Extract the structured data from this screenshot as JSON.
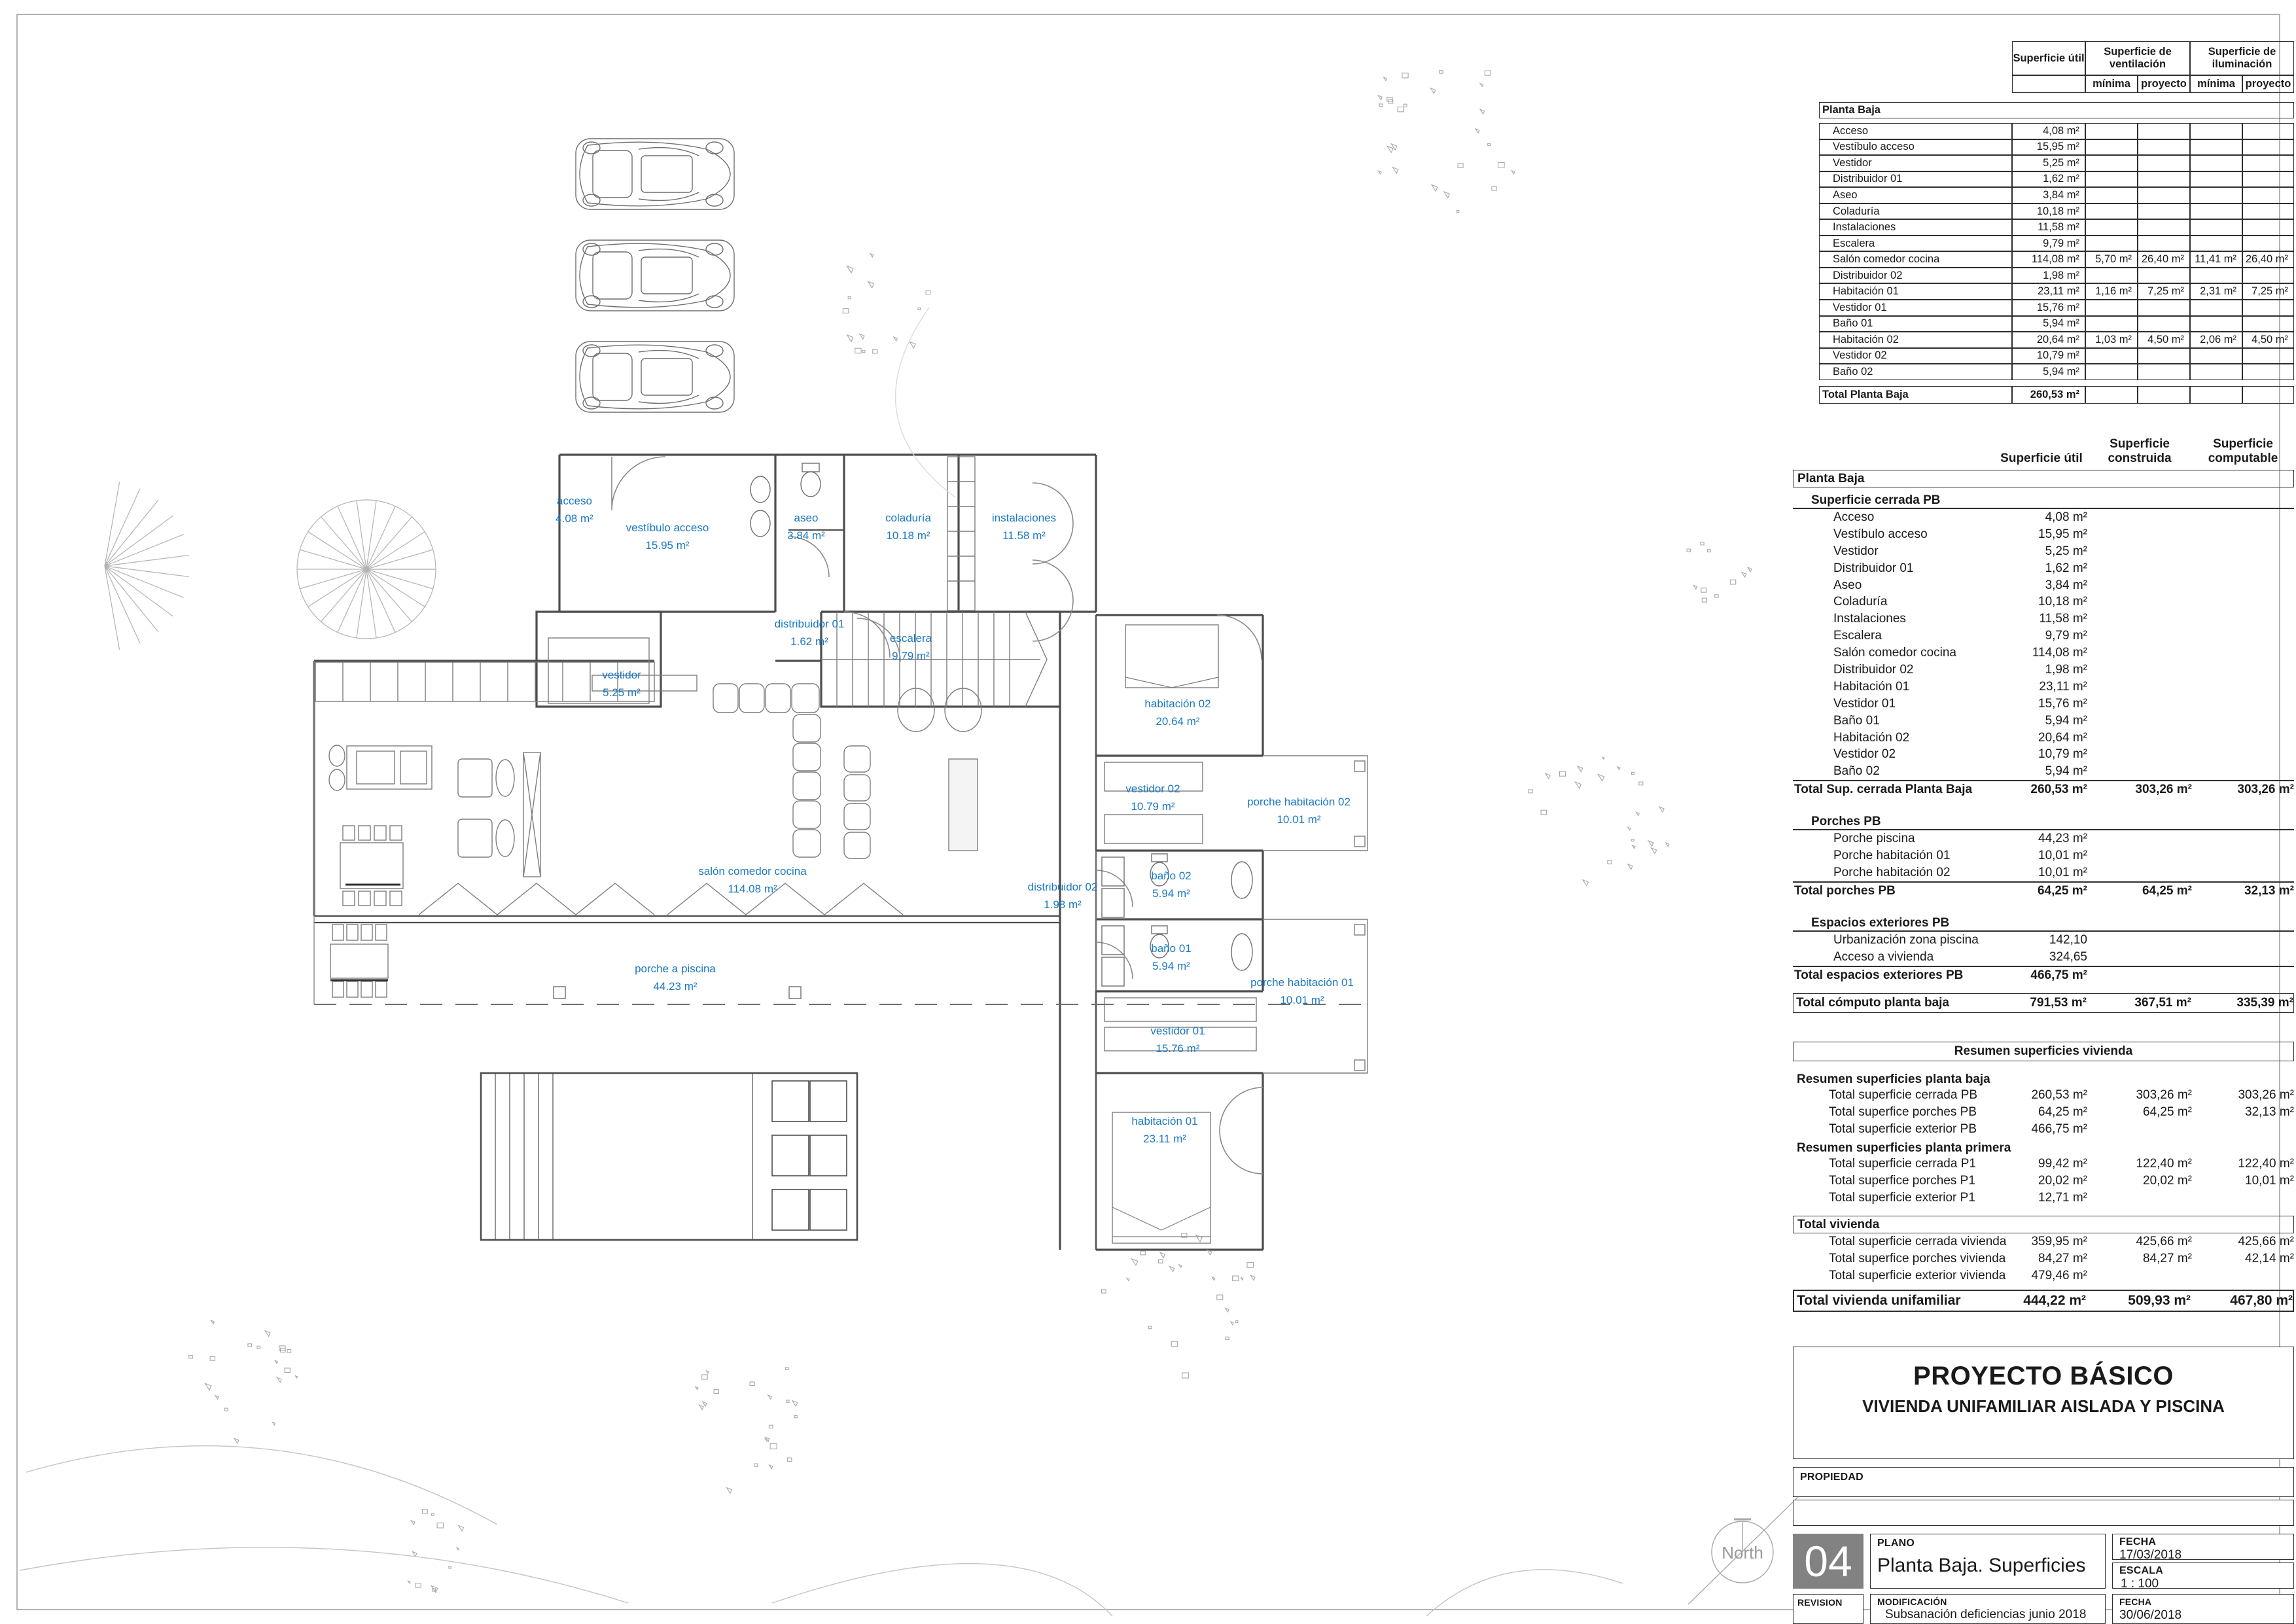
{
  "colors": {
    "accent_blue": "#1b79c2",
    "wall_line": "#4d4d4d",
    "table_line": "#2e2e2e",
    "sheet_number_bg": "#828282"
  },
  "plan": {
    "north_label": "North",
    "rooms": [
      {
        "name": "acceso",
        "area": "4.08 m²"
      },
      {
        "name": "vestíbulo acceso",
        "area": "15.95 m²"
      },
      {
        "name": "aseo",
        "area": "3.84 m²"
      },
      {
        "name": "coladuría",
        "area": "10.18 m²"
      },
      {
        "name": "instalaciones",
        "area": "11.58 m²"
      },
      {
        "name": "distribuidor 01",
        "area": "1.62 m²"
      },
      {
        "name": "vestidor",
        "area": "5.25 m²"
      },
      {
        "name": "escalera",
        "area": "9.79 m²"
      },
      {
        "name": "habitación 02",
        "area": "20.64 m²"
      },
      {
        "name": "vestidor 02",
        "area": "10.79 m²"
      },
      {
        "name": "porche habitación 02",
        "area": "10.01 m²"
      },
      {
        "name": "salón comedor cocina",
        "area": "114.08 m²"
      },
      {
        "name": "distribuidor 02",
        "area": "1.98 m²"
      },
      {
        "name": "baño 02",
        "area": "5.94 m²"
      },
      {
        "name": "baño 01",
        "area": "5.94 m²"
      },
      {
        "name": "porche a piscina",
        "area": "44.23 m²"
      },
      {
        "name": "porche habitación 01",
        "area": "10.01 m²"
      },
      {
        "name": "vestidor 01",
        "area": "15.76 m²"
      },
      {
        "name": "habitación 01",
        "area": "23.11 m²"
      }
    ]
  },
  "vent_table": {
    "header_util": "Superficie útil",
    "header_vent": "Superficie de ventilación",
    "header_ilum": "Superficie de iluminación",
    "sub_headers": [
      "mínima",
      "proyecto",
      "mínima",
      "proyecto"
    ],
    "section": "Planta Baja",
    "rows": [
      {
        "label": "Acceso",
        "util": "4,08 m²",
        "v": [
          "",
          "",
          "",
          ""
        ]
      },
      {
        "label": "Vestíbulo acceso",
        "util": "15,95 m²",
        "v": [
          "",
          "",
          "",
          ""
        ]
      },
      {
        "label": "Vestidor",
        "util": "5,25 m²",
        "v": [
          "",
          "",
          "",
          ""
        ]
      },
      {
        "label": "Distribuidor 01",
        "util": "1,62 m²",
        "v": [
          "",
          "",
          "",
          ""
        ]
      },
      {
        "label": "Aseo",
        "util": "3,84 m²",
        "v": [
          "",
          "",
          "",
          ""
        ]
      },
      {
        "label": "Coladuría",
        "util": "10,18 m²",
        "v": [
          "",
          "",
          "",
          ""
        ]
      },
      {
        "label": "Instalaciones",
        "util": "11,58 m²",
        "v": [
          "",
          "",
          "",
          ""
        ]
      },
      {
        "label": "Escalera",
        "util": "9,79 m²",
        "v": [
          "",
          "",
          "",
          ""
        ]
      },
      {
        "label": "Salón comedor cocina",
        "util": "114,08 m²",
        "v": [
          "5,70 m²",
          "26,40 m²",
          "11,41 m²",
          "26,40 m²"
        ]
      },
      {
        "label": "Distribuidor 02",
        "util": "1,98 m²",
        "v": [
          "",
          "",
          "",
          ""
        ]
      },
      {
        "label": "Habitación 01",
        "util": "23,11 m²",
        "v": [
          "1,16 m²",
          "7,25 m²",
          "2,31 m²",
          "7,25 m²"
        ]
      },
      {
        "label": "Vestidor 01",
        "util": "15,76 m²",
        "v": [
          "",
          "",
          "",
          ""
        ]
      },
      {
        "label": "Baño 01",
        "util": "5,94 m²",
        "v": [
          "",
          "",
          "",
          ""
        ]
      },
      {
        "label": "Habitación 02",
        "util": "20,64 m²",
        "v": [
          "1,03 m²",
          "4,50 m²",
          "2,06 m²",
          "4,50 m²"
        ]
      },
      {
        "label": "Vestidor 02",
        "util": "10,79 m²",
        "v": [
          "",
          "",
          "",
          ""
        ]
      },
      {
        "label": "Baño 02",
        "util": "5,94 m²",
        "v": [
          "",
          "",
          "",
          ""
        ]
      }
    ],
    "total": {
      "label": "Total Planta Baja",
      "util": "260,53 m²"
    }
  },
  "sup_table": {
    "header_cols": [
      "Superficie útil",
      "Superficie construida",
      "Superficie computable"
    ],
    "section": "Planta Baja",
    "groups": [
      {
        "header": "Superficie cerrada PB",
        "rows": [
          [
            "Acceso",
            "4,08 m²",
            "",
            ""
          ],
          [
            "Vestíbulo acceso",
            "15,95 m²",
            "",
            ""
          ],
          [
            "Vestidor",
            "5,25 m²",
            "",
            ""
          ],
          [
            "Distribuidor 01",
            "1,62 m²",
            "",
            ""
          ],
          [
            "Aseo",
            "3,84 m²",
            "",
            ""
          ],
          [
            "Coladuría",
            "10,18 m²",
            "",
            ""
          ],
          [
            "Instalaciones",
            "11,58 m²",
            "",
            ""
          ],
          [
            "Escalera",
            "9,79 m²",
            "",
            ""
          ],
          [
            "Salón comedor cocina",
            "114,08 m²",
            "",
            ""
          ],
          [
            "Distribuidor 02",
            "1,98 m²",
            "",
            ""
          ],
          [
            "Habitación 01",
            "23,11 m²",
            "",
            ""
          ],
          [
            "Vestidor 01",
            "15,76 m²",
            "",
            ""
          ],
          [
            "Baño 01",
            "5,94 m²",
            "",
            ""
          ],
          [
            "Habitación 02",
            "20,64 m²",
            "",
            ""
          ],
          [
            "Vestidor 02",
            "10,79 m²",
            "",
            ""
          ],
          [
            "Baño 02",
            "5,94 m²",
            "",
            ""
          ]
        ],
        "total": [
          "Total Sup. cerrada Planta Baja",
          "260,53 m²",
          "303,26 m²",
          "303,26 m²"
        ]
      },
      {
        "header": "Porches PB",
        "rows": [
          [
            "Porche piscina",
            "44,23 m²",
            "",
            ""
          ],
          [
            "Porche habitación  01",
            "10,01 m²",
            "",
            ""
          ],
          [
            "Porche habitación  02",
            "10,01 m²",
            "",
            ""
          ]
        ],
        "total": [
          "Total porches PB",
          "64,25 m²",
          "64,25 m²",
          "32,13 m²"
        ]
      },
      {
        "header": "Espacios exteriores PB",
        "rows": [
          [
            "Urbanización zona piscina",
            "142,10",
            "",
            ""
          ],
          [
            "Acceso a vivienda",
            "324,65",
            "",
            ""
          ]
        ],
        "total": [
          "Total espacios exteriores PB",
          "466,75 m²",
          "",
          ""
        ]
      }
    ],
    "grand_total": [
      "Total cómputo planta baja",
      "791,53 m²",
      "367,51 m²",
      "335,39 m²"
    ]
  },
  "resumen": {
    "title": "Resumen superficies vivienda",
    "groups": [
      {
        "header": "Resumen superficies planta baja",
        "rows": [
          [
            "Total superficie cerrada PB",
            "260,53 m²",
            "303,26 m²",
            "303,26 m²"
          ],
          [
            "Total superfice porches PB",
            "64,25 m²",
            "64,25 m²",
            "32,13 m²"
          ],
          [
            "Total superficie exterior PB",
            "466,75 m²",
            "",
            ""
          ]
        ]
      },
      {
        "header": "Resumen superficies planta primera",
        "rows": [
          [
            "Total superficie cerrada P1",
            "99,42 m²",
            "122,40 m²",
            "122,40 m²"
          ],
          [
            "Total superfice porches P1",
            "20,02 m²",
            "20,02 m²",
            "10,01 m²"
          ],
          [
            "Total superficie exterior P1",
            "12,71 m²",
            "",
            ""
          ]
        ]
      }
    ],
    "total_vivienda_header": "Total vivienda",
    "total_vivienda_rows": [
      [
        "Total superficie cerrada vivienda",
        "359,95 m²",
        "425,66 m²",
        "425,66 m²"
      ],
      [
        "Total superfice porches vivienda",
        "84,27 m²",
        "84,27 m²",
        "42,14 m²"
      ],
      [
        "Total superficie exterior vivienda",
        "479,46 m²",
        "",
        ""
      ]
    ],
    "grand_total": [
      "Total vivienda unifamiliar",
      "444,22 m²",
      "509,93 m²",
      "467,80 m²"
    ]
  },
  "title_block": {
    "project_title": "PROYECTO BÁSICO",
    "project_subtitle": "VIVIENDA UNIFAMILIAR AISLADA Y PISCINA",
    "propiedad_label": "PROPIEDAD",
    "sheet_number": "04",
    "plano_label": "PLANO",
    "plano_value": "Planta Baja. Superficies",
    "fecha_label": "FECHA",
    "fecha_value": "17/03/2018",
    "escala_label": "ESCALA",
    "escala_value": "1 : 100",
    "revision_label": "REVISION",
    "modificacion_label": "MODIFICACIÓN",
    "modificacion_value": "Subsanación  deficiencias junio 2018",
    "fecha2_label": "FECHA",
    "fecha2_value": "30/06/2018"
  }
}
